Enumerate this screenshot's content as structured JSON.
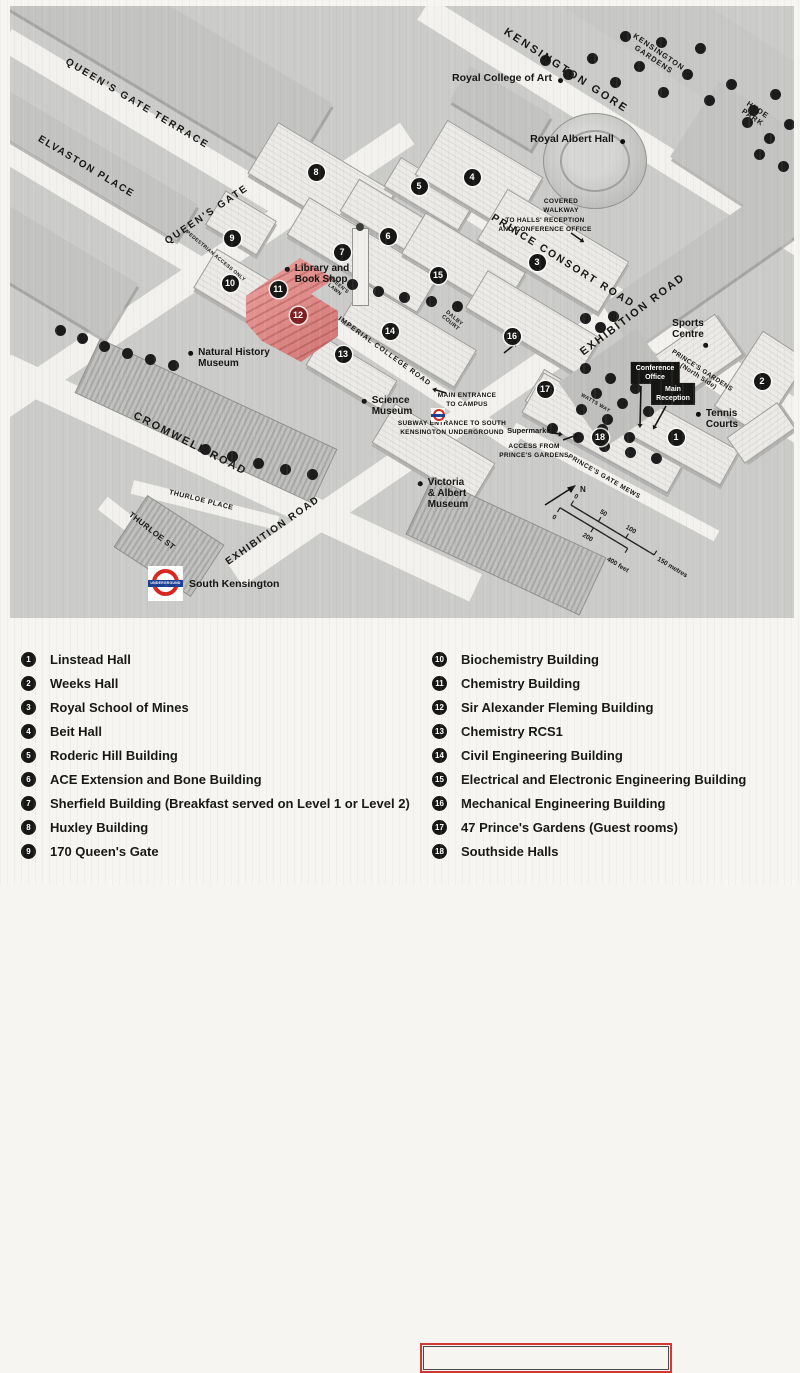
{
  "colors": {
    "map_bg": "#cbcbc9",
    "street": "#f2f1ee",
    "tree": "#1c1c1c",
    "campus_building": "#eceae7",
    "city_block": "#c3c3c1",
    "highlight_building_top": "#eda2a0",
    "highlight_building_side": "#cf7472",
    "highlight_marker": "#7c2022",
    "marker_bg": "#161614",
    "marker_text": "#ffffff",
    "underground_red": "#d7261d",
    "underground_blue": "#1c3f94",
    "legend_highlight_border": "#d03a34",
    "legend_bg": "#f6f5f2",
    "text": "#161614"
  },
  "map": {
    "street_labels": [
      {
        "text": "QUEEN'S GATE TERRACE",
        "x": 137,
        "y": 104,
        "rot": 31,
        "size": 10,
        "ls": 2
      },
      {
        "text": "ELVASTON PLACE",
        "x": 86,
        "y": 167,
        "rot": 31,
        "size": 10,
        "ls": 1.5
      },
      {
        "text": "QUEEN'S GATE",
        "x": 207,
        "y": 215,
        "rot": -34,
        "size": 10,
        "ls": 2
      },
      {
        "text": "KENSINGTON GORE",
        "x": 566,
        "y": 71,
        "rot": 33,
        "size": 11,
        "ls": 2.5
      },
      {
        "text": "PRINCE CONSORT ROAD",
        "x": 563,
        "y": 261,
        "rot": 32,
        "size": 10.5,
        "ls": 2
      },
      {
        "text": "EXHIBITION ROAD",
        "x": 633,
        "y": 315,
        "rot": -37,
        "size": 11,
        "ls": 2
      },
      {
        "text": "EXHIBITION ROAD",
        "x": 273,
        "y": 531,
        "rot": -35,
        "size": 10,
        "ls": 1.5
      },
      {
        "text": "CROMWELL ROAD",
        "x": 190,
        "y": 444,
        "rot": 27,
        "size": 11,
        "ls": 2
      },
      {
        "text": "IMPERIAL COLLEGE ROAD",
        "x": 384,
        "y": 352,
        "rot": 36,
        "size": 7,
        "ls": 1
      },
      {
        "text": "KENSINGTON\nGARDENS",
        "x": 656,
        "y": 56,
        "rot": 34,
        "size": 7.5,
        "ls": 1
      },
      {
        "text": "HYDE PARK",
        "x": 755,
        "y": 114,
        "rot": 34,
        "size": 7.5,
        "ls": 1
      },
      {
        "text": "PRINCE'S GARDENS (North Side)",
        "x": 700,
        "y": 374,
        "rot": 33,
        "size": 6.5,
        "ls": 0.4
      },
      {
        "text": "PRINCE'S GATE MEWS",
        "x": 604,
        "y": 477,
        "rot": 30,
        "size": 6.5,
        "ls": 0.6
      },
      {
        "text": "THURLOE PLACE",
        "x": 201,
        "y": 501,
        "rot": 14,
        "size": 7,
        "ls": 0.5
      },
      {
        "text": "THURLOE ST",
        "x": 152,
        "y": 531,
        "rot": 38,
        "size": 8,
        "ls": 0.5
      },
      {
        "text": "WATTS WAY",
        "x": 595,
        "y": 404,
        "rot": 30,
        "size": 5,
        "ls": 0.4
      },
      {
        "text": "QUEEN'S\nLAWN",
        "x": 336,
        "y": 288,
        "rot": 40,
        "size": 5,
        "ls": 0.3
      },
      {
        "text": "DALBY\nCOURT",
        "x": 452,
        "y": 321,
        "rot": 40,
        "size": 5.5,
        "ls": 0.3
      },
      {
        "text": "PEDESTRIAN ACCESS ONLY",
        "x": 215,
        "y": 257,
        "rot": 40,
        "size": 5,
        "ls": 0.3
      }
    ],
    "place_labels": [
      {
        "text": "Royal College of Art",
        "x": 502,
        "y": 79,
        "dot": "right",
        "size": 10.5
      },
      {
        "text": "Royal Albert Hall",
        "x": 572,
        "y": 140,
        "dot": "right",
        "size": 10.5
      },
      {
        "text": "Natural History\nMuseum",
        "x": 234,
        "y": 358,
        "dot": "left",
        "size": 10,
        "align": "left"
      },
      {
        "text": "Science\nMuseum",
        "x": 392,
        "y": 406,
        "dot": "left",
        "size": 10,
        "align": "left"
      },
      {
        "text": "Victoria\n& Albert\nMuseum",
        "x": 448,
        "y": 494,
        "dot": "left",
        "size": 10,
        "align": "left"
      },
      {
        "text": "Library and\nBook Shop",
        "x": 322,
        "y": 274,
        "dot": "left",
        "size": 10,
        "align": "left"
      },
      {
        "text": "Sports\nCentre",
        "x": 688,
        "y": 329,
        "dot": "below",
        "size": 10
      },
      {
        "text": "Tennis\nCourts",
        "x": 722,
        "y": 419,
        "dot": "left",
        "size": 10,
        "align": "left"
      },
      {
        "text": "Supermarket",
        "x": 530,
        "y": 431,
        "dot": "none",
        "size": 7.5
      }
    ],
    "tag_boxes": [
      {
        "text": "Conference\nOffice",
        "x": 655,
        "y": 373
      },
      {
        "text": "Main\nReception",
        "x": 673,
        "y": 394
      }
    ],
    "small_labels": [
      {
        "text": "COVERED\nWALKWAY",
        "x": 561,
        "y": 207
      },
      {
        "text": "TO HALLS' RECEPTION\nAND CONFERENCE OFFICE",
        "x": 545,
        "y": 226
      },
      {
        "text": "MAIN ENTRANCE\nTO CAMPUS",
        "x": 467,
        "y": 401
      },
      {
        "text": "SUBWAY ENTRANCE TO SOUTH\nKENSINGTON UNDERGROUND",
        "x": 452,
        "y": 429
      },
      {
        "text": "ACCESS FROM\nPRINCE'S GARDENS",
        "x": 534,
        "y": 452
      }
    ],
    "markers": [
      {
        "num": "1",
        "x": 676,
        "y": 437
      },
      {
        "num": "2",
        "x": 762,
        "y": 381
      },
      {
        "num": "3",
        "x": 537,
        "y": 262
      },
      {
        "num": "4",
        "x": 472,
        "y": 177
      },
      {
        "num": "5",
        "x": 419,
        "y": 186
      },
      {
        "num": "6",
        "x": 388,
        "y": 236
      },
      {
        "num": "7",
        "x": 342,
        "y": 252
      },
      {
        "num": "8",
        "x": 316,
        "y": 172
      },
      {
        "num": "9",
        "x": 232,
        "y": 238
      },
      {
        "num": "10",
        "x": 230,
        "y": 283
      },
      {
        "num": "11",
        "x": 278,
        "y": 289
      },
      {
        "num": "12",
        "x": 298,
        "y": 315,
        "highlight": true
      },
      {
        "num": "13",
        "x": 343,
        "y": 354
      },
      {
        "num": "14",
        "x": 390,
        "y": 331
      },
      {
        "num": "15",
        "x": 438,
        "y": 275
      },
      {
        "num": "16",
        "x": 512,
        "y": 336
      },
      {
        "num": "17",
        "x": 545,
        "y": 389
      },
      {
        "num": "18",
        "x": 600,
        "y": 437
      }
    ],
    "station": {
      "name": "South Kensington",
      "roundel_text": "UNDERGROUND"
    },
    "scale": {
      "metre_ticks": [
        "0",
        "50",
        "100"
      ],
      "metre_end": "150 metres",
      "feet_ticks": [
        "0",
        "200"
      ],
      "feet_end": "400 feet",
      "north": "N"
    }
  },
  "legend": {
    "columns": [
      {
        "items": [
          {
            "num": "1",
            "label": "Linstead Hall"
          },
          {
            "num": "2",
            "label": "Weeks Hall"
          },
          {
            "num": "3",
            "label": "Royal School of Mines"
          },
          {
            "num": "4",
            "label": "Beit Hall"
          },
          {
            "num": "5",
            "label": "Roderic Hill Building"
          },
          {
            "num": "6",
            "label": "ACE Extension and Bone Building"
          },
          {
            "num": "7",
            "label": "Sherfield Building (Breakfast served on Level 1 or Level 2)"
          },
          {
            "num": "8",
            "label": "Huxley Building"
          },
          {
            "num": "9",
            "label": "170 Queen's Gate"
          }
        ]
      },
      {
        "items": [
          {
            "num": "10",
            "label": "Biochemistry Building"
          },
          {
            "num": "11",
            "label": "Chemistry Building"
          },
          {
            "num": "12",
            "label": "Sir Alexander Fleming Building",
            "highlight": true
          },
          {
            "num": "13",
            "label": "Chemistry RCS1"
          },
          {
            "num": "14",
            "label": "Civil Engineering Building"
          },
          {
            "num": "15",
            "label": "Electrical and Electronic Engineering Building"
          },
          {
            "num": "16",
            "label": "Mechanical Engineering Building"
          },
          {
            "num": "17",
            "label": "47 Prince's Gardens (Guest rooms)"
          },
          {
            "num": "18",
            "label": "Southside Halls"
          }
        ]
      }
    ]
  },
  "deco": {
    "streets": [
      [
        190,
        150,
        430,
        24,
        31
      ],
      [
        95,
        205,
        300,
        22,
        31
      ],
      [
        175,
        290,
        560,
        26,
        -34
      ],
      [
        615,
        128,
        450,
        26,
        32
      ],
      [
        625,
        305,
        430,
        24,
        32
      ],
      [
        520,
        380,
        690,
        26,
        -34.5
      ],
      [
        240,
        478,
        520,
        30,
        25
      ],
      [
        420,
        382,
        230,
        16,
        33
      ],
      [
        205,
        505,
        150,
        14,
        14
      ],
      [
        150,
        540,
        120,
        16,
        38
      ],
      [
        715,
        382,
        220,
        16,
        33
      ],
      [
        615,
        482,
        230,
        12,
        28
      ]
    ],
    "blocks": [
      [
        165,
        52,
        340,
        85,
        31,
        "city"
      ],
      [
        80,
        158,
        250,
        42,
        31,
        "city"
      ],
      [
        40,
        262,
        190,
        65,
        31,
        "city"
      ],
      [
        660,
        22,
        360,
        80,
        33,
        "park"
      ],
      [
        770,
        168,
        180,
        90,
        33,
        "city"
      ],
      [
        720,
        255,
        250,
        55,
        -35,
        "city"
      ],
      [
        500,
        108,
        95,
        40,
        31,
        "city"
      ],
      [
        320,
        182,
        135,
        58,
        31,
        "lite"
      ],
      [
        362,
        254,
        150,
        42,
        31,
        "lite"
      ],
      [
        398,
        224,
        115,
        36,
        31,
        "lite"
      ],
      [
        428,
        193,
        85,
        32,
        31,
        "lite"
      ],
      [
        478,
        175,
        110,
        62,
        31,
        "lite"
      ],
      [
        552,
        250,
        140,
        58,
        31,
        "lite"
      ],
      [
        462,
        262,
        115,
        46,
        31,
        "lite"
      ],
      [
        408,
        334,
        130,
        42,
        31,
        "lite"
      ],
      [
        532,
        322,
        130,
        42,
        31,
        "lite"
      ],
      [
        350,
        372,
        85,
        32,
        31,
        "lite"
      ],
      [
        252,
        296,
        110,
        44,
        31,
        "lite"
      ],
      [
        240,
        222,
        58,
        38,
        31,
        "lite"
      ],
      [
        560,
        400,
        60,
        36,
        31,
        "lite"
      ],
      [
        604,
        432,
        165,
        44,
        29,
        "lite"
      ],
      [
        680,
        440,
        110,
        38,
        29,
        "lite"
      ],
      [
        760,
        382,
        52,
        88,
        33,
        "lite"
      ],
      [
        692,
        358,
        85,
        48,
        -35,
        "lite"
      ],
      [
        432,
        452,
        115,
        44,
        31,
        "lite"
      ],
      [
        760,
        432,
        60,
        30,
        -35,
        "lite"
      ],
      [
        205,
        420,
        260,
        58,
        25,
        "dark"
      ],
      [
        505,
        545,
        190,
        62,
        25,
        "dark"
      ],
      [
        168,
        545,
        90,
        60,
        33,
        "dark"
      ],
      [
        620,
        388,
        95,
        80,
        -35,
        "park2"
      ]
    ],
    "trees": [
      [
        545,
        60
      ],
      [
        568,
        74
      ],
      [
        592,
        58
      ],
      [
        615,
        82
      ],
      [
        639,
        66
      ],
      [
        663,
        92
      ],
      [
        687,
        74
      ],
      [
        709,
        100
      ],
      [
        731,
        84
      ],
      [
        753,
        110
      ],
      [
        775,
        94
      ],
      [
        700,
        48
      ],
      [
        661,
        42
      ],
      [
        625,
        36
      ],
      [
        747,
        122
      ],
      [
        769,
        138
      ],
      [
        789,
        124
      ],
      [
        759,
        154
      ],
      [
        783,
        166
      ],
      [
        585,
        318
      ],
      [
        600,
        327
      ],
      [
        613,
        316
      ],
      [
        352,
        284
      ],
      [
        378,
        291
      ],
      [
        404,
        297
      ],
      [
        431,
        301
      ],
      [
        457,
        306
      ],
      [
        60,
        330
      ],
      [
        82,
        338
      ],
      [
        104,
        346
      ],
      [
        127,
        353
      ],
      [
        150,
        359
      ],
      [
        173,
        365
      ],
      [
        205,
        449
      ],
      [
        232,
        456
      ],
      [
        258,
        463
      ],
      [
        285,
        469
      ],
      [
        312,
        474
      ],
      [
        552,
        428
      ],
      [
        578,
        437
      ],
      [
        604,
        446
      ],
      [
        630,
        452
      ],
      [
        656,
        458
      ],
      [
        602,
        429
      ],
      [
        629,
        437
      ],
      [
        585,
        368
      ],
      [
        610,
        378
      ],
      [
        635,
        388
      ],
      [
        596,
        393
      ],
      [
        622,
        403
      ],
      [
        648,
        411
      ],
      [
        581,
        409
      ],
      [
        607,
        419
      ]
    ]
  }
}
